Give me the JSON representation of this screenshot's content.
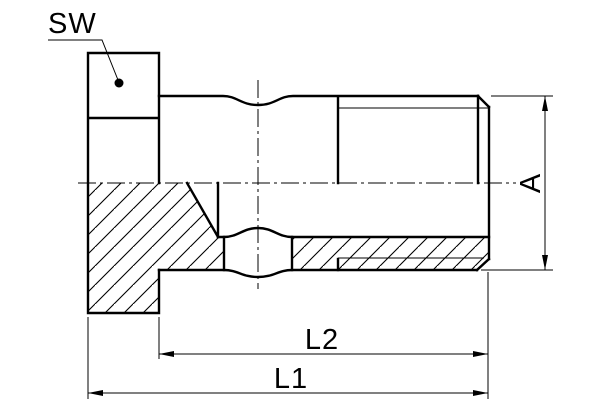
{
  "drawing": {
    "type": "engineering-section-drawing",
    "subject": "hollow banjo screw cross-section",
    "labels": {
      "sw": "SW",
      "a": "A",
      "l1": "L1",
      "l2": "L2"
    },
    "colors": {
      "line": "#000000",
      "background": "#ffffff"
    }
  }
}
